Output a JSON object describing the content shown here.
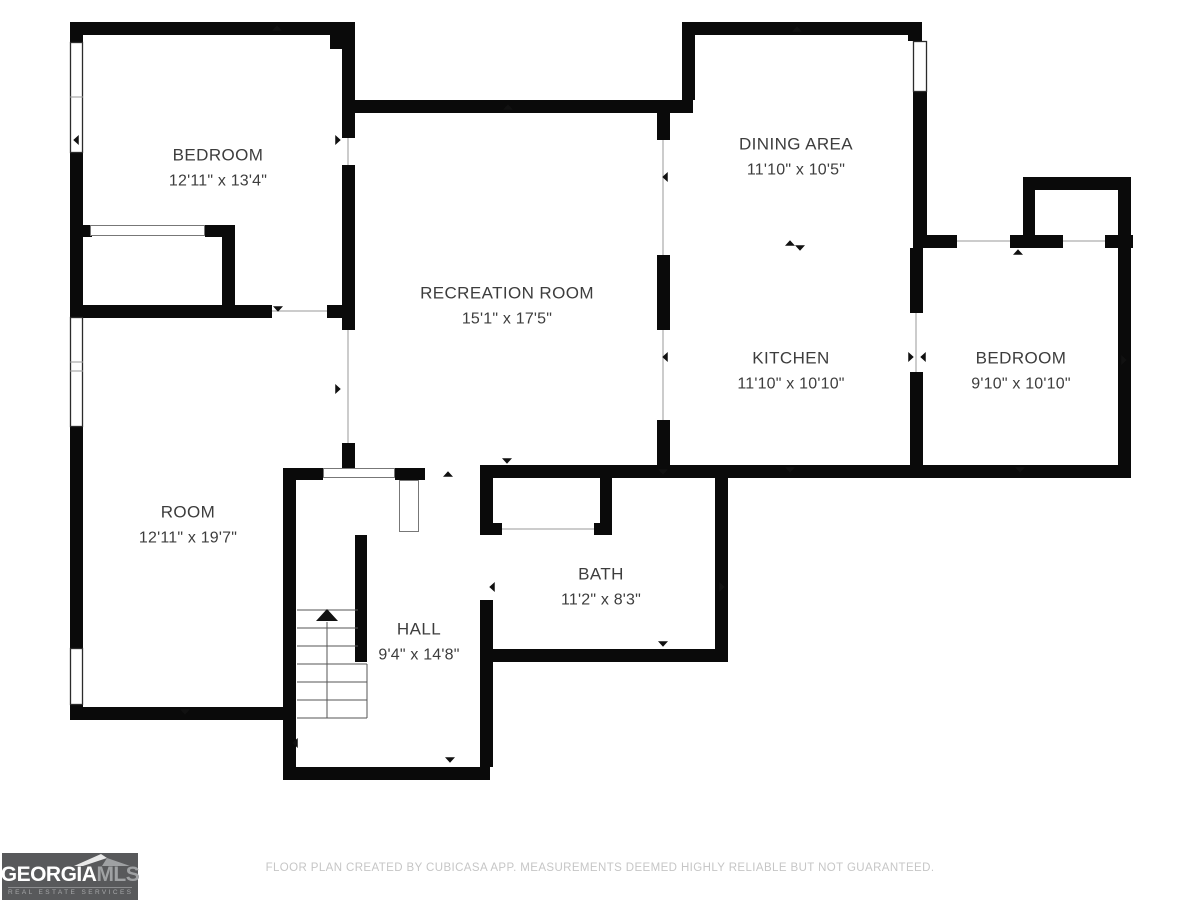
{
  "footer": {
    "disclaimer": "FLOOR PLAN CREATED BY CUBICASA APP. MEASUREMENTS DEEMED HIGHLY RELIABLE BUT NOT GUARANTEED."
  },
  "logo": {
    "wordmark_part1": "GEORGIA",
    "wordmark_part2": "MLS",
    "tagline": "REAL ESTATE SERVICES",
    "background": "#58595b",
    "part1_color": "#ffffff",
    "part2_color": "#9fa1a3"
  },
  "rooms": [
    {
      "id": "bedroom-1",
      "name": "BEDROOM",
      "dims": "12'11\" x 13'4\"",
      "cx": 218,
      "cy": 168
    },
    {
      "id": "recreation",
      "name": "RECREATION ROOM",
      "dims": "15'1\" x 17'5\"",
      "cx": 507,
      "cy": 306
    },
    {
      "id": "dining",
      "name": "DINING AREA",
      "dims": "11'10\" x 10'5\"",
      "cx": 796,
      "cy": 157
    },
    {
      "id": "kitchen",
      "name": "KITCHEN",
      "dims": "11'10\" x 10'10\"",
      "cx": 791,
      "cy": 371
    },
    {
      "id": "bedroom-2",
      "name": "BEDROOM",
      "dims": "9'10\" x 10'10\"",
      "cx": 1021,
      "cy": 371
    },
    {
      "id": "room",
      "name": "ROOM",
      "dims": "12'11\" x 19'7\"",
      "cx": 188,
      "cy": 525
    },
    {
      "id": "hall",
      "name": "HALL",
      "dims": "9'4\" x 14'8\"",
      "cx": 419,
      "cy": 642
    },
    {
      "id": "bath",
      "name": "BATH",
      "dims": "11'2\" x 8'3\"",
      "cx": 601,
      "cy": 587
    }
  ],
  "floorplan": {
    "wall_color": "#0a0a0a",
    "window_stroke": "#2b2b2b",
    "opening_stroke": "#9a9a9a",
    "stair_stroke": "#555555",
    "marker_color": "#111111",
    "walls": [
      [
        70,
        22,
        285,
        13
      ],
      [
        330,
        35,
        25,
        14
      ],
      [
        70,
        35,
        13,
        10
      ],
      [
        70,
        153,
        13,
        164
      ],
      [
        70,
        427,
        13,
        221
      ],
      [
        70,
        705,
        13,
        15
      ],
      [
        70,
        225,
        22,
        12
      ],
      [
        205,
        225,
        30,
        12
      ],
      [
        222,
        237,
        13,
        80
      ],
      [
        70,
        305,
        202,
        13
      ],
      [
        327,
        305,
        28,
        13
      ],
      [
        342,
        35,
        13,
        103
      ],
      [
        342,
        165,
        13,
        140
      ],
      [
        342,
        305,
        13,
        25
      ],
      [
        342,
        443,
        13,
        25
      ],
      [
        352,
        100,
        341,
        13
      ],
      [
        682,
        22,
        13,
        78
      ],
      [
        682,
        22,
        240,
        13
      ],
      [
        908,
        33,
        14,
        8
      ],
      [
        913,
        92,
        14,
        143
      ],
      [
        657,
        113,
        13,
        27
      ],
      [
        657,
        255,
        13,
        75
      ],
      [
        657,
        420,
        13,
        48
      ],
      [
        657,
        465,
        266,
        13
      ],
      [
        910,
        248,
        13,
        65
      ],
      [
        910,
        372,
        13,
        93
      ],
      [
        913,
        235,
        44,
        13
      ],
      [
        1010,
        235,
        53,
        13
      ],
      [
        1105,
        235,
        28,
        13
      ],
      [
        1023,
        177,
        12,
        58
      ],
      [
        1023,
        177,
        108,
        13
      ],
      [
        1118,
        177,
        13,
        71
      ],
      [
        1118,
        248,
        13,
        230
      ],
      [
        910,
        465,
        221,
        13
      ],
      [
        480,
        465,
        240,
        13
      ],
      [
        480,
        478,
        13,
        57
      ],
      [
        480,
        523,
        22,
        12
      ],
      [
        480,
        600,
        13,
        62
      ],
      [
        600,
        478,
        12,
        57
      ],
      [
        594,
        523,
        18,
        12
      ],
      [
        715,
        465,
        13,
        197
      ],
      [
        480,
        649,
        248,
        13
      ],
      [
        283,
        468,
        40,
        12
      ],
      [
        395,
        468,
        30,
        12
      ],
      [
        283,
        468,
        13,
        312
      ],
      [
        283,
        767,
        207,
        13
      ],
      [
        480,
        662,
        13,
        105
      ],
      [
        355,
        535,
        12,
        127
      ],
      [
        70,
        707,
        226,
        13
      ]
    ],
    "windows": [
      [
        70,
        42,
        13,
        111
      ],
      [
        70,
        317,
        13,
        110
      ],
      [
        70,
        648,
        13,
        57
      ],
      [
        913,
        41,
        14,
        51
      ]
    ],
    "door_leafs": [
      [
        90,
        225,
        115,
        11
      ],
      [
        323,
        468,
        72,
        10
      ],
      [
        399,
        480,
        20,
        52
      ]
    ],
    "opening_lines": [
      [
        272,
        311,
        327,
        311
      ],
      [
        348,
        138,
        348,
        165
      ],
      [
        348,
        330,
        348,
        443
      ],
      [
        663,
        140,
        663,
        255
      ],
      [
        663,
        330,
        663,
        420
      ],
      [
        916,
        313,
        916,
        372
      ],
      [
        957,
        241,
        1010,
        241
      ],
      [
        1063,
        241,
        1105,
        241
      ],
      [
        502,
        529,
        594,
        529
      ],
      [
        70,
        97,
        83,
        97
      ],
      [
        70,
        362,
        83,
        362
      ],
      [
        70,
        371,
        83,
        371
      ]
    ],
    "stair_lines": [
      [
        297,
        610,
        358,
        610
      ],
      [
        297,
        628,
        358,
        628
      ],
      [
        297,
        646,
        358,
        646
      ],
      [
        297,
        664,
        367,
        664
      ],
      [
        297,
        682,
        367,
        682
      ],
      [
        297,
        700,
        367,
        700
      ],
      [
        297,
        718,
        367,
        718
      ],
      [
        367,
        664,
        367,
        718
      ],
      [
        327,
        622,
        327,
        718
      ]
    ],
    "markers": [
      [
        277,
        28,
        "up"
      ],
      [
        508,
        107,
        "up"
      ],
      [
        797,
        29,
        "up"
      ],
      [
        76,
        140,
        "left"
      ],
      [
        338,
        140,
        "right"
      ],
      [
        278,
        309,
        "down"
      ],
      [
        185,
        712,
        "down"
      ],
      [
        665,
        177,
        "left"
      ],
      [
        338,
        389,
        "right"
      ],
      [
        665,
        357,
        "left"
      ],
      [
        790,
        243,
        "up"
      ],
      [
        800,
        248,
        "down"
      ],
      [
        911,
        357,
        "right"
      ],
      [
        923,
        357,
        "left"
      ],
      [
        1124,
        360,
        "right"
      ],
      [
        1018,
        252,
        "up"
      ],
      [
        790,
        470,
        "down"
      ],
      [
        1020,
        470,
        "down"
      ],
      [
        507,
        461,
        "down"
      ],
      [
        663,
        472,
        "down"
      ],
      [
        492,
        587,
        "left"
      ],
      [
        722,
        587,
        "right"
      ],
      [
        663,
        644,
        "down"
      ],
      [
        448,
        474,
        "up"
      ],
      [
        295,
        743,
        "left"
      ],
      [
        450,
        760,
        "down"
      ],
      [
        327,
        615,
        "up",
        11
      ]
    ]
  }
}
